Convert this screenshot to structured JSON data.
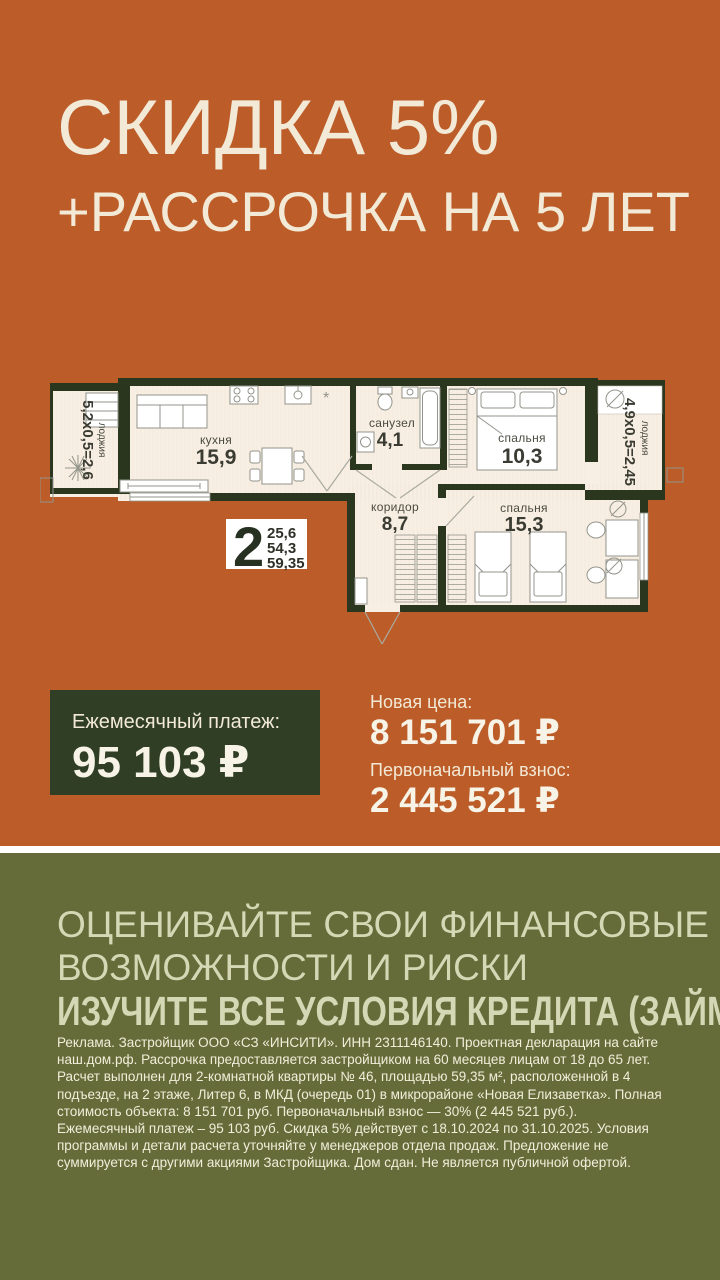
{
  "meta": {
    "kind": "real-estate promo banner",
    "colors": {
      "orange_bg": "#BC5C28",
      "olive_bg": "#656C39",
      "dark_green_box": "#2F3E24",
      "cream_text": "#F2E9D6",
      "plan_interior": "#F8EFE4",
      "plan_walls": "#2B361F",
      "warning_text": "#D5D8B5",
      "divider": "#FFFFFF"
    }
  },
  "hero": {
    "line1": "СКИДКА 5%",
    "line2": "+РАССРОЧКА НА 5 ЛЕТ"
  },
  "floorplan": {
    "info": {
      "rooms": "2",
      "area1": "25,6",
      "area2": "54,3",
      "area3": "59,35"
    },
    "rooms": {
      "kitchen": {
        "name": "кухня",
        "area": "15,9"
      },
      "bathroom": {
        "name": "санузел",
        "area": "4,1"
      },
      "bedroom_small": {
        "name": "спальня",
        "area": "10,3"
      },
      "corridor": {
        "name": "коридор",
        "area": "8,7"
      },
      "bedroom_large": {
        "name": "спальня",
        "area": "15,3"
      }
    },
    "balcony_left": {
      "dims": "5,2x0,5=2,6",
      "name": "лоджия"
    },
    "balcony_right": {
      "dims": "4,9x0,5=2,45",
      "name": "лоджия"
    },
    "kitchen_star": "*"
  },
  "offer": {
    "monthly": {
      "label": "Ежемесячный платеж:",
      "value": "95 103 ₽"
    },
    "price": {
      "label": "Новая цена:",
      "value": "8 151 701 ₽"
    },
    "downpayment": {
      "label": "Первоначальный взнос:",
      "value": "2 445 521 ₽"
    }
  },
  "warning": {
    "line1": "ОЦЕНИВАЙТЕ СВОИ ФИНАНСОВЫЕ",
    "line2": "ВОЗМОЖНОСТИ И РИСКИ",
    "line3": "ИЗУЧИТЕ ВСЕ УСЛОВИЯ КРЕДИТА (ЗАЙМА)"
  },
  "legal": {
    "text": "Реклама. Застройщик ООО «СЗ «ИНСИТИ». ИНН 2311146140. Проектная декларация на сайте наш.дом.рф. Рассрочка предоставляется застройщиком на 60 месяцев лицам от 18 до 65 лет. Расчет выполнен для 2-комнатной квартиры № 46, площадью 59,35 м², расположенной в 4 подъезде, на 2 этаже, Литер 6, в МКД (очередь 01) в микрорайоне «Новая Елизаветка». Полная стоимость объекта: 8 151 701 руб. Первоначальный взнос — 30% (2 445 521 руб.). Ежемесячный платеж – 95 103 руб. Скидка 5% действует с 18.10.2024 по 31.10.2025. Условия программы и детали расчета уточняйте у менеджеров отдела продаж. Предложение не суммируется с другими акциями Застройщика. Дом сдан. Не является публичной офертой."
  }
}
